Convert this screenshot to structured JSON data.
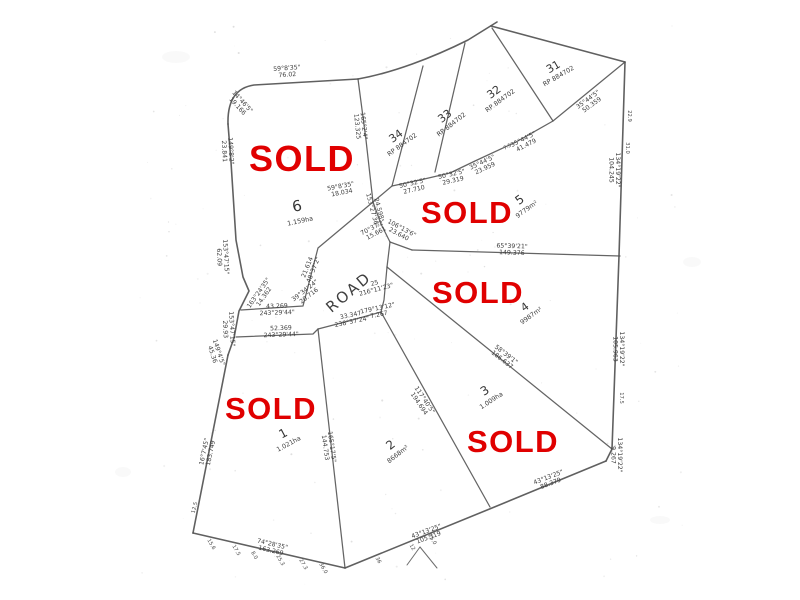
{
  "plan": {
    "road_label": "ROAD",
    "sold_text": "SOLD",
    "colors": {
      "sold_red": "#e00000",
      "line_gray": "#535353",
      "text_gray": "#3d3d3d",
      "paper": "#ffffff"
    },
    "sold_stamps": [
      {
        "x": 302,
        "y": 171,
        "size": 36
      },
      {
        "x": 467,
        "y": 223,
        "size": 31
      },
      {
        "x": 478,
        "y": 303,
        "size": 31
      },
      {
        "x": 271,
        "y": 419,
        "size": 31
      },
      {
        "x": 513,
        "y": 452,
        "size": 31
      }
    ],
    "lots": [
      {
        "number": "6",
        "sub": "1.159ha",
        "x": 298,
        "y": 211,
        "rotate": -12,
        "size": 15
      },
      {
        "number": "5",
        "sub": "9779m²",
        "x": 522,
        "y": 203,
        "rotate": -36,
        "size": 12
      },
      {
        "number": "4",
        "sub": "9987m²",
        "x": 527,
        "y": 310,
        "rotate": -36,
        "size": 11
      },
      {
        "number": "3",
        "sub": "1.009ha",
        "x": 487,
        "y": 394,
        "rotate": -33,
        "size": 12
      },
      {
        "number": "2",
        "sub": "8668m²",
        "x": 393,
        "y": 448,
        "rotate": -38,
        "size": 12
      },
      {
        "number": "1",
        "sub": "1.021ha",
        "x": 285,
        "y": 437,
        "rotate": -28,
        "size": 12
      },
      {
        "number": "34",
        "sub": "RP 884702",
        "x": 398,
        "y": 139,
        "rotate": -36,
        "size": 11
      },
      {
        "number": "33",
        "sub": "RP 884702",
        "x": 447,
        "y": 119,
        "rotate": -38,
        "size": 11
      },
      {
        "number": "32",
        "sub": "RP 884702",
        "x": 496,
        "y": 95,
        "rotate": -36,
        "size": 11
      },
      {
        "number": "31",
        "sub": "RP 884702",
        "x": 555,
        "y": 70,
        "rotate": -30,
        "size": 11
      }
    ],
    "bearing_labels": [
      {
        "line1": "59°8'35\"",
        "line2": "76.02",
        "x": 287,
        "y": 70,
        "rotate": -4
      },
      {
        "line1": "14°46'5\"",
        "line2": "19.166",
        "x": 241,
        "y": 103,
        "rotate": 48
      },
      {
        "line1": "149°8'2\"",
        "line2": "23.841",
        "x": 229,
        "y": 151,
        "rotate": 87
      },
      {
        "line1": "153°47'15\"",
        "line2": "62.09",
        "x": 224,
        "y": 257,
        "rotate": 87
      },
      {
        "line1": "153°47'15\"",
        "line2": "29.93",
        "x": 230,
        "y": 329,
        "rotate": 87
      },
      {
        "line1": "149°4'5\"",
        "line2": "45.36",
        "x": 217,
        "y": 353,
        "rotate": 72
      },
      {
        "line1": "16°7'45\"",
        "line2": "183.749",
        "x": 206,
        "y": 452,
        "rotate": -78
      },
      {
        "line1": "74°28'35\"",
        "line2": "163.269",
        "x": 272,
        "y": 546,
        "rotate": 13
      },
      {
        "line1": "43°13'25\"",
        "line2": "105.319",
        "x": 427,
        "y": 533,
        "rotate": -20
      },
      {
        "line1": "43°13'25\"",
        "line2": "88.379",
        "x": 549,
        "y": 479,
        "rotate": -21
      },
      {
        "line1": "134°19'22\"",
        "line2": "9.267",
        "x": 618,
        "y": 455,
        "rotate": 90
      },
      {
        "line1": "134°19'22\"",
        "line2": "105.963",
        "x": 620,
        "y": 349,
        "rotate": 90
      },
      {
        "line1": "134°19'22\"",
        "line2": "104.245",
        "x": 616,
        "y": 170,
        "rotate": 90
      },
      {
        "line1": "35°44'5\"",
        "line2": "50.359",
        "x": 589,
        "y": 101,
        "rotate": -36
      },
      {
        "line1": "35°44'5\"",
        "line2": "41.479",
        "x": 524,
        "y": 141,
        "rotate": -27
      },
      {
        "line1": "35°44'5\"",
        "line2": "23.959",
        "x": 483,
        "y": 164,
        "rotate": -25
      },
      {
        "line1": "50°32'5\"",
        "line2": "29.319",
        "x": 452,
        "y": 176,
        "rotate": -13
      },
      {
        "line1": "50°32'5\"",
        "line2": "27.710",
        "x": 413,
        "y": 185,
        "rotate": -13
      },
      {
        "line1": "59°8'35\"",
        "line2": "18.034",
        "x": 341,
        "y": 188,
        "rotate": -11
      },
      {
        "line1": "165°2'4\"",
        "line2": "123.325",
        "x": 362,
        "y": 126,
        "rotate": 84
      },
      {
        "line1": "24.598",
        "line2": "153°27'36\"",
        "x": 377,
        "y": 209,
        "rotate": 75
      },
      {
        "line1": "70°37'2\"",
        "line2": "15.661",
        "x": 374,
        "y": 229,
        "rotate": -28
      },
      {
        "line1": "106°13'6\"",
        "line2": "23.640",
        "x": 401,
        "y": 230,
        "rotate": 28
      },
      {
        "line1": "65°39'21\"",
        "line2": "149.376",
        "x": 512,
        "y": 248,
        "rotate": 2
      },
      {
        "line1": "25",
        "line2": "216°11'23\"",
        "x": 375,
        "y": 285,
        "rotate": -15
      },
      {
        "line1": "179°13'12\"",
        "line2": "7.267",
        "x": 378,
        "y": 310,
        "rotate": -12
      },
      {
        "line1": "33.347",
        "line2": "238°37'24\"",
        "x": 351,
        "y": 317,
        "rotate": -12
      },
      {
        "line1": "43.269",
        "line2": "243°29'44\"",
        "x": 277,
        "y": 308,
        "rotate": -2
      },
      {
        "line1": "52.369",
        "line2": "243°29'44\"",
        "x": 281,
        "y": 330,
        "rotate": -2
      },
      {
        "line1": "39°34'24\"",
        "line2": "20.716",
        "x": 306,
        "y": 292,
        "rotate": -38
      },
      {
        "line1": "21.614",
        "line2": "48°37'2\"",
        "x": 309,
        "y": 268,
        "rotate": -68
      },
      {
        "line1": "163°24'35\"",
        "line2": "14.362",
        "x": 260,
        "y": 294,
        "rotate": -55
      },
      {
        "line1": "58°39'1\"",
        "line2": "186.637",
        "x": 505,
        "y": 356,
        "rotate": 38
      },
      {
        "line1": "117°40'5\"",
        "line2": "194.694",
        "x": 423,
        "y": 401,
        "rotate": 56
      },
      {
        "line1": "165°17'5\"",
        "line2": "144.753",
        "x": 330,
        "y": 447,
        "rotate": 82
      }
    ],
    "tick_labels": [
      {
        "text": "22.9",
        "x": 628,
        "y": 116,
        "rotate": 90
      },
      {
        "text": "31.0",
        "x": 626,
        "y": 148,
        "rotate": 90
      },
      {
        "text": "17.5",
        "x": 620,
        "y": 398,
        "rotate": 90
      },
      {
        "text": "15.6",
        "x": 210,
        "y": 545,
        "rotate": 60
      },
      {
        "text": "17.5",
        "x": 235,
        "y": 551,
        "rotate": 60
      },
      {
        "text": "8.0",
        "x": 253,
        "y": 556,
        "rotate": 60
      },
      {
        "text": "25.3",
        "x": 279,
        "y": 561,
        "rotate": 60
      },
      {
        "text": "27.3",
        "x": 302,
        "y": 565,
        "rotate": 60
      },
      {
        "text": "36.0",
        "x": 322,
        "y": 569,
        "rotate": 60
      },
      {
        "text": "36",
        "x": 377,
        "y": 561,
        "rotate": 60
      },
      {
        "text": "12",
        "x": 411,
        "y": 548,
        "rotate": 60
      },
      {
        "text": "25.0",
        "x": 431,
        "y": 540,
        "rotate": 60
      },
      {
        "text": "12.5",
        "x": 196,
        "y": 508,
        "rotate": -75
      },
      {
        "text": "7.5",
        "x": 508,
        "y": 148,
        "rotate": -27
      }
    ]
  }
}
